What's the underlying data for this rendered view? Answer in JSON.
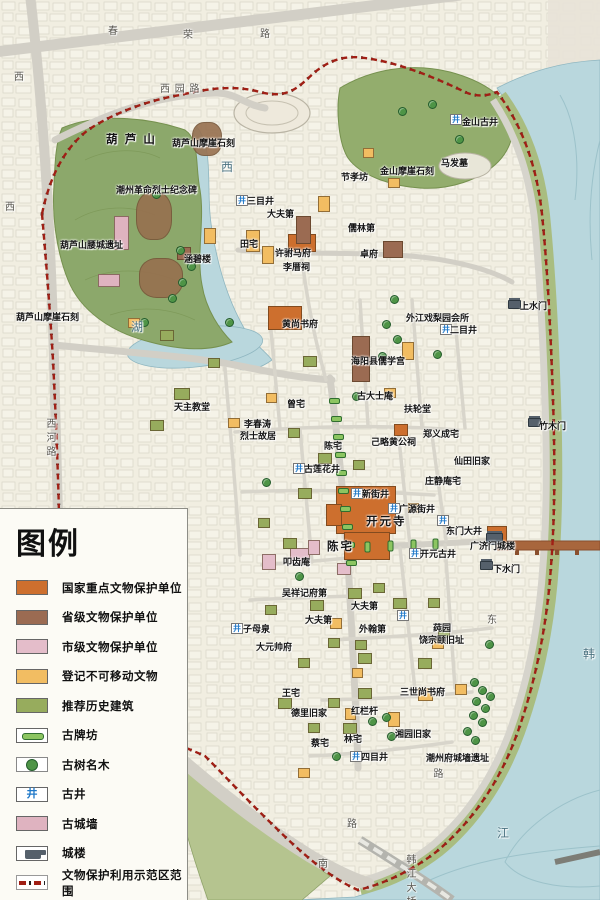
{
  "palette": {
    "nat": "#cd6f2e",
    "prov": "#9b6b52",
    "mun": "#e4bdca",
    "reg": "#f2bd62",
    "rec": "#97ac5d",
    "wall": "#dfb3c0",
    "rock": "#97704f",
    "water": "#b9d7dd",
    "hill": "#8ca86b",
    "hill2": "#93ad6d",
    "band": "#a9bd80",
    "boundary": "#a01f15",
    "well": "#1f78c8",
    "tree": "#4e9446",
    "gate": "#55606b",
    "bridge": "#a8663d",
    "road": "#d2cfc6",
    "park": "#b5c48f"
  },
  "legend": {
    "title": "图例",
    "items": [
      {
        "label": "国家重点文物保护单位",
        "bg": "#cd6f2e",
        "cls": "sw-fill"
      },
      {
        "label": "省级文物保护单位",
        "bg": "#9b6b52",
        "cls": "sw-fill"
      },
      {
        "label": "市级文物保护单位",
        "bg": "#e4bdca",
        "cls": "sw-fill"
      },
      {
        "label": "登记不可移动文物",
        "bg": "#f2bd62",
        "cls": "sw-fill"
      },
      {
        "label": "推荐历史建筑",
        "bg": "#97ac5d",
        "cls": "sw-fill"
      },
      {
        "label": "古牌坊",
        "cls": "sw-paifang"
      },
      {
        "label": "古树名木",
        "cls": "sw-tree"
      },
      {
        "label": "古井",
        "cls": "sw-well"
      },
      {
        "label": "古城墙",
        "bg": "#dfb3c0",
        "cls": "sw-fill"
      },
      {
        "label": "城楼",
        "cls": "sw-gate"
      },
      {
        "label": "文物保护利用示范区范围",
        "cls": "sw-bound"
      }
    ]
  },
  "map": {
    "icons": {
      "well": "井"
    },
    "labels": [
      {
        "t": "春",
        "x": 108,
        "y": 22,
        "cls": "road"
      },
      {
        "t": "荣",
        "x": 183,
        "y": 26,
        "cls": "road"
      },
      {
        "t": "路",
        "x": 260,
        "y": 25,
        "cls": "road"
      },
      {
        "t": "西",
        "x": 14,
        "y": 68,
        "cls": "road"
      },
      {
        "t": "西",
        "x": 5,
        "y": 198,
        "cls": "road"
      },
      {
        "t": "西 园 路",
        "x": 160,
        "y": 80,
        "cls": "road"
      },
      {
        "t": "西河路",
        "x": 42,
        "y": 418,
        "cls": "road vert"
      },
      {
        "t": "西",
        "x": 221,
        "y": 158,
        "cls": "water"
      },
      {
        "t": "湖",
        "x": 131,
        "y": 318,
        "cls": "water"
      },
      {
        "t": "韩",
        "x": 583,
        "y": 645,
        "cls": "water"
      },
      {
        "t": "江",
        "x": 497,
        "y": 824,
        "cls": "water"
      },
      {
        "t": "东",
        "x": 487,
        "y": 611,
        "cls": "road"
      },
      {
        "t": "南",
        "x": 318,
        "y": 855,
        "cls": "road"
      },
      {
        "t": "路",
        "x": 347,
        "y": 815,
        "cls": "road"
      },
      {
        "t": "路",
        "x": 429,
        "y": 768,
        "cls": "road vert"
      },
      {
        "t": "韩江大桥",
        "x": 402,
        "y": 854,
        "cls": "road vert"
      },
      {
        "t": "葫 芦 山",
        "x": 106,
        "y": 131,
        "cls": "big"
      },
      {
        "t": "葫芦山摩崖石刻",
        "x": 172,
        "y": 136
      },
      {
        "t": "潮州革命烈士纪念碑",
        "x": 116,
        "y": 183
      },
      {
        "t": "葫芦山腰城遗址",
        "x": 60,
        "y": 238
      },
      {
        "t": "涵碧楼",
        "x": 184,
        "y": 252
      },
      {
        "t": "葫芦山摩崖石刻",
        "x": 16,
        "y": 310
      },
      {
        "t": "金山古井",
        "x": 462,
        "y": 115
      },
      {
        "t": "马发墓",
        "x": 441,
        "y": 156
      },
      {
        "t": "金山摩崖石刻",
        "x": 380,
        "y": 164
      },
      {
        "t": "节孝坊",
        "x": 341,
        "y": 170
      },
      {
        "t": "三目井",
        "x": 247,
        "y": 194
      },
      {
        "t": "大夫第",
        "x": 267,
        "y": 207
      },
      {
        "t": "儒林第",
        "x": 348,
        "y": 221
      },
      {
        "t": "田宅",
        "x": 240,
        "y": 237
      },
      {
        "t": "许驸马府",
        "x": 275,
        "y": 246
      },
      {
        "t": "卓府",
        "x": 360,
        "y": 247
      },
      {
        "t": "李厝祠",
        "x": 283,
        "y": 260
      },
      {
        "t": "外江戏梨园会所",
        "x": 406,
        "y": 311
      },
      {
        "t": "二目井",
        "x": 450,
        "y": 323
      },
      {
        "t": "上水门",
        "x": 520,
        "y": 299
      },
      {
        "t": "黄尚书府",
        "x": 282,
        "y": 317
      },
      {
        "t": "海阳县儒学宫",
        "x": 351,
        "y": 354
      },
      {
        "t": "古大士庵",
        "x": 357,
        "y": 389
      },
      {
        "t": "曾宅",
        "x": 287,
        "y": 397
      },
      {
        "t": "扶轮堂",
        "x": 404,
        "y": 402
      },
      {
        "t": "天主教堂",
        "x": 174,
        "y": 400
      },
      {
        "t": "李春涛",
        "x": 244,
        "y": 417
      },
      {
        "t": "烈士故居",
        "x": 240,
        "y": 429
      },
      {
        "t": "陈宅",
        "x": 324,
        "y": 439
      },
      {
        "t": "己略黄公祠",
        "x": 371,
        "y": 435
      },
      {
        "t": "郑义成宅",
        "x": 423,
        "y": 427
      },
      {
        "t": "竹木门",
        "x": 539,
        "y": 419
      },
      {
        "t": "仙田旧家",
        "x": 454,
        "y": 454
      },
      {
        "t": "古莲花井",
        "x": 304,
        "y": 462
      },
      {
        "t": "庄静庵宅",
        "x": 425,
        "y": 474
      },
      {
        "t": "新街井",
        "x": 362,
        "y": 487
      },
      {
        "t": "广源街井",
        "x": 399,
        "y": 502
      },
      {
        "t": "开元寺",
        "x": 366,
        "y": 513,
        "cls": "big"
      },
      {
        "t": "东门大井",
        "x": 446,
        "y": 524
      },
      {
        "t": "开元古井",
        "x": 420,
        "y": 547
      },
      {
        "t": "广济门城楼",
        "x": 470,
        "y": 539
      },
      {
        "t": "下水门",
        "x": 493,
        "y": 562
      },
      {
        "t": "陈宅",
        "x": 327,
        "y": 538,
        "cls": "big"
      },
      {
        "t": "叩齿庵",
        "x": 283,
        "y": 555
      },
      {
        "t": "吴祥记府第",
        "x": 282,
        "y": 586
      },
      {
        "t": "大夫第",
        "x": 351,
        "y": 599
      },
      {
        "t": "大夫第",
        "x": 305,
        "y": 613
      },
      {
        "t": "外翰第",
        "x": 359,
        "y": 622
      },
      {
        "t": "子母泉",
        "x": 243,
        "y": 622
      },
      {
        "t": "大元帅府",
        "x": 256,
        "y": 640
      },
      {
        "t": "莼园",
        "x": 433,
        "y": 621
      },
      {
        "t": "饶宗颐旧址",
        "x": 419,
        "y": 633
      },
      {
        "t": "三世尚书府",
        "x": 400,
        "y": 685
      },
      {
        "t": "王宅",
        "x": 282,
        "y": 686
      },
      {
        "t": "德里旧家",
        "x": 291,
        "y": 706
      },
      {
        "t": "红栏杆",
        "x": 351,
        "y": 704
      },
      {
        "t": "湘园旧家",
        "x": 395,
        "y": 727
      },
      {
        "t": "蔡宅",
        "x": 311,
        "y": 736
      },
      {
        "t": "林宅",
        "x": 344,
        "y": 732
      },
      {
        "t": "四目井",
        "x": 361,
        "y": 750
      },
      {
        "t": "潮州府城墙遗址",
        "x": 426,
        "y": 751
      }
    ],
    "wells": [
      {
        "x": 450,
        "y": 114
      },
      {
        "x": 236,
        "y": 195
      },
      {
        "x": 440,
        "y": 324
      },
      {
        "x": 293,
        "y": 463
      },
      {
        "x": 351,
        "y": 488
      },
      {
        "x": 388,
        "y": 503
      },
      {
        "x": 409,
        "y": 548
      },
      {
        "x": 231,
        "y": 623
      },
      {
        "x": 350,
        "y": 751
      },
      {
        "x": 437,
        "y": 515
      },
      {
        "x": 397,
        "y": 610
      }
    ],
    "trees": [
      {
        "x": 398,
        "y": 107
      },
      {
        "x": 428,
        "y": 100
      },
      {
        "x": 455,
        "y": 135
      },
      {
        "x": 352,
        "y": 392
      },
      {
        "x": 152,
        "y": 190
      },
      {
        "x": 176,
        "y": 246
      },
      {
        "x": 187,
        "y": 262
      },
      {
        "x": 178,
        "y": 278
      },
      {
        "x": 168,
        "y": 294
      },
      {
        "x": 140,
        "y": 318
      },
      {
        "x": 225,
        "y": 318
      },
      {
        "x": 390,
        "y": 295
      },
      {
        "x": 382,
        "y": 320
      },
      {
        "x": 393,
        "y": 335
      },
      {
        "x": 433,
        "y": 350
      },
      {
        "x": 378,
        "y": 352
      },
      {
        "x": 485,
        "y": 640
      },
      {
        "x": 368,
        "y": 717
      },
      {
        "x": 382,
        "y": 713
      },
      {
        "x": 387,
        "y": 732
      },
      {
        "x": 332,
        "y": 752
      },
      {
        "x": 470,
        "y": 678
      },
      {
        "x": 478,
        "y": 686
      },
      {
        "x": 486,
        "y": 692
      },
      {
        "x": 472,
        "y": 697
      },
      {
        "x": 481,
        "y": 704
      },
      {
        "x": 469,
        "y": 711
      },
      {
        "x": 478,
        "y": 718
      },
      {
        "x": 463,
        "y": 727
      },
      {
        "x": 471,
        "y": 736
      },
      {
        "x": 295,
        "y": 572
      },
      {
        "x": 262,
        "y": 478
      }
    ],
    "gates": [
      {
        "x": 508,
        "y": 300
      },
      {
        "x": 528,
        "y": 418
      },
      {
        "x": 486,
        "y": 533,
        "cls": "big"
      },
      {
        "x": 480,
        "y": 561
      }
    ],
    "bars": [
      {
        "x": 329,
        "y": 398
      },
      {
        "x": 331,
        "y": 416
      },
      {
        "x": 333,
        "y": 434
      },
      {
        "x": 335,
        "y": 452
      },
      {
        "x": 336,
        "y": 470
      },
      {
        "x": 338,
        "y": 488
      },
      {
        "x": 340,
        "y": 506
      },
      {
        "x": 342,
        "y": 524
      },
      {
        "x": 344,
        "y": 542
      },
      {
        "x": 346,
        "y": 560
      },
      {
        "x": 362,
        "y": 544,
        "cls": "v"
      },
      {
        "x": 385,
        "y": 543,
        "cls": "v"
      },
      {
        "x": 408,
        "y": 542,
        "cls": "v"
      },
      {
        "x": 430,
        "y": 541,
        "cls": "v"
      }
    ],
    "buildings": [
      {
        "x": 192,
        "y": 122,
        "w": 28,
        "h": 32,
        "cls": "b-rock"
      },
      {
        "x": 136,
        "y": 192,
        "w": 34,
        "h": 46,
        "cls": "b-rock"
      },
      {
        "x": 139,
        "y": 258,
        "w": 42,
        "h": 38,
        "cls": "b-rock"
      },
      {
        "x": 114,
        "y": 216,
        "w": 13,
        "h": 32,
        "cls": "b-wall"
      },
      {
        "x": 98,
        "y": 274,
        "w": 20,
        "h": 11,
        "cls": "b-wall"
      },
      {
        "x": 288,
        "y": 234,
        "w": 26,
        "h": 16,
        "cls": "b-nat"
      },
      {
        "x": 268,
        "y": 306,
        "w": 32,
        "h": 22,
        "cls": "b-nat"
      },
      {
        "x": 336,
        "y": 486,
        "w": 58,
        "h": 46,
        "cls": "b-nat"
      },
      {
        "x": 344,
        "y": 532,
        "w": 44,
        "h": 26,
        "cls": "b-nat"
      },
      {
        "x": 326,
        "y": 504,
        "w": 14,
        "h": 20,
        "cls": "b-nat"
      },
      {
        "x": 394,
        "y": 424,
        "w": 12,
        "h": 10,
        "cls": "b-nat"
      },
      {
        "x": 487,
        "y": 526,
        "w": 18,
        "h": 16,
        "cls": "b-nat"
      },
      {
        "x": 383,
        "y": 241,
        "w": 18,
        "h": 15,
        "cls": "b-prov"
      },
      {
        "x": 352,
        "y": 336,
        "w": 16,
        "h": 44,
        "cls": "b-prov"
      },
      {
        "x": 296,
        "y": 216,
        "w": 13,
        "h": 26,
        "cls": "b-prov"
      },
      {
        "x": 177,
        "y": 247,
        "w": 12,
        "h": 11,
        "cls": "b-prov"
      },
      {
        "x": 290,
        "y": 548,
        "w": 18,
        "h": 13,
        "cls": "b-mun"
      },
      {
        "x": 262,
        "y": 554,
        "w": 12,
        "h": 14,
        "cls": "b-mun"
      },
      {
        "x": 308,
        "y": 540,
        "w": 10,
        "h": 13,
        "cls": "b-mun"
      },
      {
        "x": 337,
        "y": 563,
        "w": 12,
        "h": 10,
        "cls": "b-mun"
      },
      {
        "x": 246,
        "y": 230,
        "w": 12,
        "h": 20,
        "cls": "b-reg"
      },
      {
        "x": 204,
        "y": 228,
        "w": 10,
        "h": 14,
        "cls": "b-reg"
      },
      {
        "x": 262,
        "y": 246,
        "w": 10,
        "h": 16,
        "cls": "b-reg"
      },
      {
        "x": 318,
        "y": 196,
        "w": 10,
        "h": 14,
        "cls": "b-reg"
      },
      {
        "x": 363,
        "y": 148,
        "w": 9,
        "h": 8,
        "cls": "b-reg"
      },
      {
        "x": 388,
        "y": 178,
        "w": 10,
        "h": 8,
        "cls": "b-reg"
      },
      {
        "x": 128,
        "y": 318,
        "w": 10,
        "h": 8,
        "cls": "b-reg"
      },
      {
        "x": 228,
        "y": 418,
        "w": 10,
        "h": 8,
        "cls": "b-reg"
      },
      {
        "x": 266,
        "y": 393,
        "w": 9,
        "h": 8,
        "cls": "b-reg"
      },
      {
        "x": 384,
        "y": 388,
        "w": 10,
        "h": 8,
        "cls": "b-reg"
      },
      {
        "x": 402,
        "y": 342,
        "w": 10,
        "h": 16,
        "cls": "b-reg"
      },
      {
        "x": 408,
        "y": 503,
        "w": 9,
        "h": 8,
        "cls": "b-reg"
      },
      {
        "x": 330,
        "y": 618,
        "w": 10,
        "h": 9,
        "cls": "b-reg"
      },
      {
        "x": 388,
        "y": 712,
        "w": 10,
        "h": 13,
        "cls": "b-reg"
      },
      {
        "x": 418,
        "y": 688,
        "w": 13,
        "h": 11,
        "cls": "b-reg"
      },
      {
        "x": 352,
        "y": 668,
        "w": 9,
        "h": 8,
        "cls": "b-reg"
      },
      {
        "x": 432,
        "y": 638,
        "w": 10,
        "h": 9,
        "cls": "b-reg"
      },
      {
        "x": 455,
        "y": 684,
        "w": 10,
        "h": 9,
        "cls": "b-reg"
      },
      {
        "x": 298,
        "y": 768,
        "w": 10,
        "h": 8,
        "cls": "b-reg"
      },
      {
        "x": 345,
        "y": 708,
        "w": 9,
        "h": 10,
        "cls": "b-reg"
      },
      {
        "x": 160,
        "y": 330,
        "w": 12,
        "h": 9,
        "cls": "b-rec"
      },
      {
        "x": 174,
        "y": 388,
        "w": 14,
        "h": 10,
        "cls": "b-rec"
      },
      {
        "x": 150,
        "y": 420,
        "w": 12,
        "h": 9,
        "cls": "b-rec"
      },
      {
        "x": 208,
        "y": 358,
        "w": 10,
        "h": 8,
        "cls": "b-rec"
      },
      {
        "x": 303,
        "y": 356,
        "w": 12,
        "h": 9,
        "cls": "b-rec"
      },
      {
        "x": 288,
        "y": 428,
        "w": 10,
        "h": 8,
        "cls": "b-rec"
      },
      {
        "x": 318,
        "y": 453,
        "w": 12,
        "h": 9,
        "cls": "b-rec"
      },
      {
        "x": 353,
        "y": 460,
        "w": 10,
        "h": 8,
        "cls": "b-rec"
      },
      {
        "x": 298,
        "y": 488,
        "w": 12,
        "h": 9,
        "cls": "b-rec"
      },
      {
        "x": 258,
        "y": 518,
        "w": 10,
        "h": 8,
        "cls": "b-rec"
      },
      {
        "x": 283,
        "y": 538,
        "w": 12,
        "h": 9,
        "cls": "b-rec"
      },
      {
        "x": 348,
        "y": 588,
        "w": 12,
        "h": 9,
        "cls": "b-rec"
      },
      {
        "x": 373,
        "y": 583,
        "w": 10,
        "h": 8,
        "cls": "b-rec"
      },
      {
        "x": 393,
        "y": 598,
        "w": 12,
        "h": 9,
        "cls": "b-rec"
      },
      {
        "x": 328,
        "y": 638,
        "w": 10,
        "h": 8,
        "cls": "b-rec"
      },
      {
        "x": 358,
        "y": 653,
        "w": 12,
        "h": 9,
        "cls": "b-rec"
      },
      {
        "x": 298,
        "y": 658,
        "w": 10,
        "h": 8,
        "cls": "b-rec"
      },
      {
        "x": 278,
        "y": 698,
        "w": 12,
        "h": 9,
        "cls": "b-rec"
      },
      {
        "x": 328,
        "y": 698,
        "w": 10,
        "h": 8,
        "cls": "b-rec"
      },
      {
        "x": 358,
        "y": 688,
        "w": 12,
        "h": 9,
        "cls": "b-rec"
      },
      {
        "x": 308,
        "y": 723,
        "w": 10,
        "h": 8,
        "cls": "b-rec"
      },
      {
        "x": 343,
        "y": 723,
        "w": 12,
        "h": 9,
        "cls": "b-rec"
      },
      {
        "x": 428,
        "y": 598,
        "w": 10,
        "h": 8,
        "cls": "b-rec"
      },
      {
        "x": 418,
        "y": 658,
        "w": 12,
        "h": 9,
        "cls": "b-rec"
      },
      {
        "x": 438,
        "y": 628,
        "w": 10,
        "h": 8,
        "cls": "b-rec"
      },
      {
        "x": 310,
        "y": 600,
        "w": 12,
        "h": 9,
        "cls": "b-rec"
      },
      {
        "x": 265,
        "y": 605,
        "w": 10,
        "h": 8,
        "cls": "b-rec"
      },
      {
        "x": 355,
        "y": 640,
        "w": 10,
        "h": 8,
        "cls": "b-rec"
      }
    ]
  }
}
